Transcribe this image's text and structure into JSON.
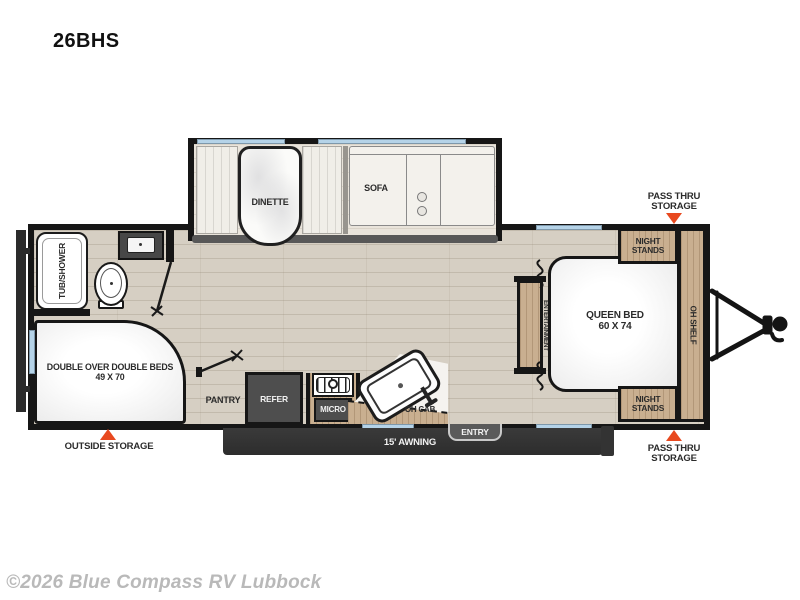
{
  "title": "26BHS",
  "footer": {
    "copyright": "©2026 Blue Compass RV Lubbock"
  },
  "colors": {
    "accent_red": "#e8491f",
    "wall": "#161616",
    "floor_wood": "#d6cfc3",
    "slide_floor": "#e9e4db",
    "cabinet_wood": "#c9af90",
    "appliance_gray": "#4e4e4e",
    "awning_dark": "#3a3a3a",
    "window_blue": "#b5d3e8",
    "label_text": "#2b2b2b"
  },
  "labels": {
    "dinette": "DINETTE",
    "sofa": "SOFA",
    "tub_shower": "TUB/SHOWER",
    "bunk": {
      "line1": "DOUBLE OVER DOUBLE BEDS",
      "line2": "49 X 70"
    },
    "pantry": "PANTRY",
    "refer": "REFER",
    "micro": "MICRO",
    "oh_cab": "OH CAB",
    "entry": "ENTRY",
    "awning": "15' AWNING",
    "entertainment": {
      "line1": "ENTERTAINMENT",
      "line2": "CENTER"
    },
    "queen": {
      "line1": "QUEEN BED",
      "line2": "60 X 74"
    },
    "night_stands_top": {
      "line1": "NIGHT",
      "line2": "STANDS"
    },
    "night_stands_bottom": {
      "line1": "NIGHT",
      "line2": "STANDS"
    },
    "oh_shelf": "OH SHELF"
  },
  "callouts": {
    "pass_thru_top": {
      "line1": "PASS THRU",
      "line2": "STORAGE"
    },
    "pass_thru_bottom": {
      "line1": "PASS THRU",
      "line2": "STORAGE"
    },
    "outside_storage": "OUTSIDE STORAGE"
  }
}
